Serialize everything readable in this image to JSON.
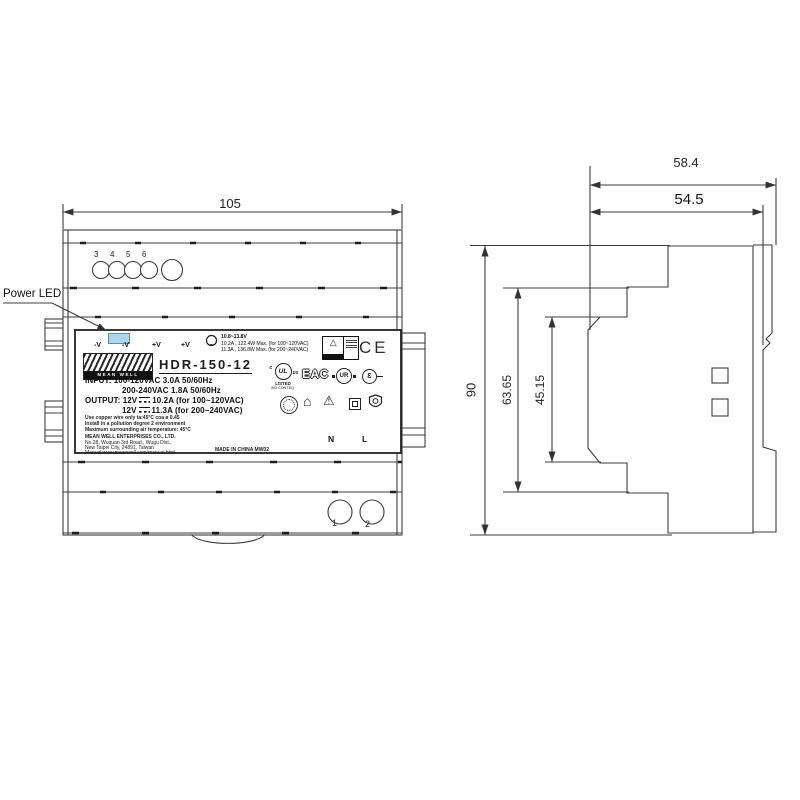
{
  "front_view": {
    "width_dim": "105",
    "power_led_label": "Power LED",
    "top_terminals": [
      "3",
      "4",
      "5",
      "6"
    ],
    "bottom_terminals": [
      "1",
      "2"
    ],
    "label": {
      "terminals": [
        "-V",
        "-V",
        "+V",
        "+V"
      ],
      "adjust_range": "10.8~13.8V",
      "max_line1": "10.2A , 122.4W Max. (for 100~120VAC)",
      "max_line2": "11.3A , 136.8W Max. (for 200~240VAC)",
      "brand_text": "MEAN WELL",
      "model": "HDR-150-12",
      "input_label": "INPUT:",
      "input_line1": "100-120VAC   3.0A   50/60Hz",
      "input_line2": "200-240VAC   1.8A   50/60Hz",
      "output_label": "OUTPUT:",
      "output1_v": "12V",
      "output1_rest": "10.2A   (for 100~120VAC)",
      "output2_v": "12V",
      "output2_rest": "11.3A   (for 200~240VAC)",
      "note1": "Use copper wire only   ta:45°C   coa ø 0.45",
      "note2": "Install in a pollution degree 2 environment",
      "note3": "Maximum surrounding air temperature: 45°C",
      "company_line1": "MEAN WELL ENTERPRISES CO., LTD.",
      "company_line2": "No.28, Wuquan 3rd Road., Wugu Dist.,",
      "company_line3": "New Taipei City, 24891, Taiwan",
      "company_line4": "Manual:www.meanwell.com/manual.html",
      "made_in": "MADE IN CHINA   MW02",
      "ce": "CE",
      "ul_text": "UL",
      "ul_c": "c",
      "ul_us": "us",
      "ul_listed": "LISTED",
      "ul_sub": "IND.CONT.EQ.",
      "eac": "EAC",
      "ur_text": "UR",
      "e_mark": "Ɛ",
      "warning_glyph": "△",
      "house_glyph": "⌂",
      "triangle_glyph": "⚠",
      "neutral": "N",
      "line": "L"
    }
  },
  "side_view": {
    "depth_total": "58.4",
    "depth_case": "54.5",
    "height_total": "90",
    "height_mid": "63.65",
    "height_inner": "45.15"
  },
  "colors": {
    "led": "#aed6ea",
    "line_color": "#3c3c3c"
  }
}
